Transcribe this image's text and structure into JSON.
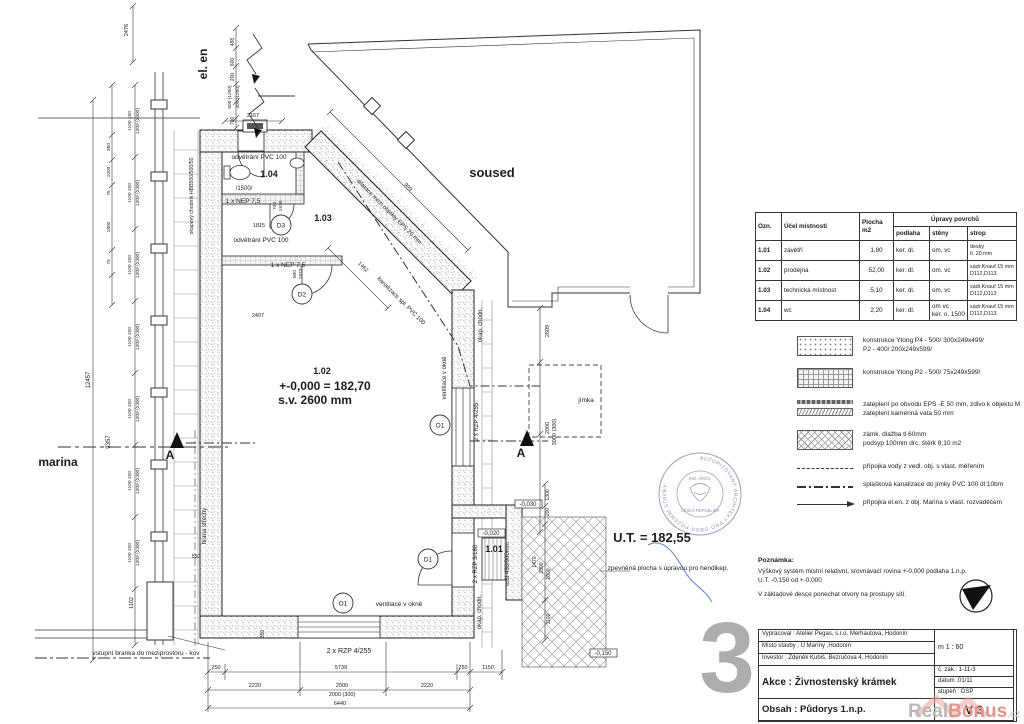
{
  "colors": {
    "ink": "#1c1c1c",
    "stamp_blue": "#8a90b2",
    "signature_blue": "#6e86c8",
    "watermark_grey": "#b8b8b8",
    "watermark_red": "#e2938b",
    "sheet_grey": "#999999"
  },
  "room_table": {
    "headers": [
      "Ozn.",
      "Účel místnosti",
      "Plocha\nm2",
      "Úpravy povrchů",
      "podlaha",
      "stěny",
      "strop"
    ],
    "rows": [
      [
        "1.01",
        "závětří",
        "1,80",
        "ker. dl.",
        "om. vc",
        "desky\ntl. 20 mm"
      ],
      [
        "1.02",
        "prodejna",
        "52,00",
        "ker. dl.",
        "om. vc",
        "sádr.Knauf 15 mm\nD112,D113"
      ],
      [
        "1.03",
        "technická místnost",
        "5,10",
        "ker. dl.",
        "om. vc",
        "sádr.Knauf 15 mm\nD112,D113"
      ],
      [
        "1.04",
        "wc",
        "2,20",
        "ker. dl.",
        "om vc\nker. o. 1500",
        "sádr.Knauf 15 mm\nD112,D113"
      ]
    ]
  },
  "legend": {
    "items": [
      {
        "swatch": "stipple",
        "flat": false,
        "lines": [
          "konstrukce  Ytong  P4 - 500/ 300x249x499/",
          "P2 - 400/ 200x249x599/"
        ]
      },
      {
        "swatch": "grid",
        "flat": false,
        "lines": [
          "konstrukce  Ytong  P2 - 500/ 75x249x599/"
        ]
      },
      {
        "swatch": "strips",
        "flat": false,
        "lines": [
          "zateplení po obvodu EPS -E  50 mm, zdivo k objektu M",
          "zateplení kamenná vata 50 mm"
        ]
      },
      {
        "swatch": "diamond",
        "flat": false,
        "lines": [
          "zámk. dlažba tl 60mm",
          "podsyp 100mm drc. štěrk  8,10 m2"
        ]
      },
      {
        "swatch": "dash",
        "flat": true,
        "lines": [
          "přípojka vody z vedl. obj. s vlast. měřením"
        ]
      },
      {
        "swatch": "dashdot",
        "flat": true,
        "lines": [
          "splašková kanalizace do jímky PVC 100 dl:10bm"
        ]
      },
      {
        "swatch": "arrow",
        "flat": true,
        "lines": [
          "přípojka el.en. z obj. Marina s vlast. rozvaděčem"
        ]
      }
    ]
  },
  "notes": {
    "title": "Poznámka:",
    "lines": [
      "Výškový systém místní relativní, srovnávací rovina +-0,000 podlaha 1.n.p.",
      "U.T. -0,150 od +-0,000",
      "V základové desce ponechat otvory na prostupy sítí."
    ]
  },
  "title_block": {
    "vypracoval": "Vypracoval : Atelier Pegas, s.r.o. Merhautova, Hodonín",
    "misto": "Místo stavby :  U Maríny ,Hodonín",
    "investor": "Investor : Zdeněk Kubiš, Bezručova 4, Hodonín",
    "akce": "Akce : Živnostenský krámek",
    "obsah": "Obsah : Půdorys 1.n.p.",
    "scale": "m  1 : 60",
    "zakazka": "č. zak.:  1-11-3",
    "datum": "datum :01/11",
    "stupen": "stupeň : DSP",
    "version": "V 3"
  },
  "sheet_number": "3",
  "stamp": {
    "ring": "AUTORIZOVANÝ ARCHITEKT PRO OBOR POZEMNÍ STAVBY",
    "inner1": "ING. ARCH.",
    "inner2": "ČESKÁ REPUBLIKA"
  },
  "watermark": {
    "real": "Real",
    "bonus": "Bonus",
    "cz": ".cz"
  },
  "plan": {
    "marks": [
      {
        "t": "D3",
        "x": 281,
        "y": 225
      },
      {
        "t": "D2",
        "x": 302,
        "y": 294
      },
      {
        "t": "D1",
        "x": 428,
        "y": 559
      },
      {
        "t": "O1",
        "x": 440,
        "y": 425
      },
      {
        "t": "O1",
        "x": 343,
        "y": 603
      }
    ],
    "labels": [
      {
        "n": "el-en-label",
        "t": "el. en",
        "x": 207,
        "y": 64,
        "r": -90,
        "s": 12,
        "b": 1
      },
      {
        "n": "soused-label",
        "t": "soused",
        "x": 492,
        "y": 177,
        "s": 13,
        "b": 1
      },
      {
        "n": "marina-label",
        "t": "marina",
        "x": 58,
        "y": 466,
        "s": 12,
        "b": 1
      },
      {
        "n": "vent-104",
        "t": "odvětrání PVC 100",
        "x": 259,
        "y": 159,
        "s": 6.5
      },
      {
        "n": "room-104-number",
        "t": "1.04",
        "x": 269,
        "y": 177,
        "s": 9,
        "b": 1
      },
      {
        "n": "flow-1500",
        "t": "/1500/",
        "x": 244,
        "y": 190,
        "s": 6
      },
      {
        "n": "nep-top",
        "t": "1 x NEP 7,5",
        "x": 243,
        "y": 203,
        "s": 6.5
      },
      {
        "n": "vent-103",
        "t": "odvětrání PVC 100",
        "x": 261,
        "y": 242,
        "s": 6.5
      },
      {
        "n": "nep-bottom",
        "t": "1 x NEP 7,5",
        "x": 288,
        "y": 267,
        "s": 6.5
      },
      {
        "n": "room-103-number",
        "t": "1.03",
        "x": 323,
        "y": 221,
        "s": 9,
        "b": 1
      },
      {
        "n": "dim-1815",
        "t": "1815",
        "x": 259,
        "y": 227,
        "s": 5.5
      },
      {
        "n": "dim-2407",
        "t": "2407",
        "x": 258,
        "y": 317,
        "s": 5.5
      },
      {
        "n": "dim-d3-700",
        "t": "700",
        "x": 276,
        "y": 206,
        "r": -90,
        "s": 4.8
      },
      {
        "n": "dim-d3-1970",
        "t": "1970",
        "x": 282,
        "y": 206,
        "r": -90,
        "s": 4.8
      },
      {
        "n": "dim-d2-800",
        "t": "800",
        "x": 296,
        "y": 274,
        "r": -90,
        "s": 4.8
      },
      {
        "n": "dim-d2-1970",
        "t": "1970",
        "x": 302,
        "y": 274,
        "r": -90,
        "s": 4.8
      },
      {
        "n": "room-102-number",
        "t": "1.02",
        "x": 322,
        "y": 374,
        "s": 9,
        "b": 1
      },
      {
        "n": "room-102-level",
        "t": "+-0,000 = 182,70",
        "x": 325,
        "y": 390,
        "s": 12,
        "b": 1
      },
      {
        "n": "room-102-height",
        "t": "s.v. 2600 mm",
        "x": 315,
        "y": 404,
        "s": 12,
        "b": 1
      },
      {
        "n": "vent-right",
        "t": "ventilace v okně",
        "x": 446,
        "y": 378,
        "r": -90,
        "s": 6
      },
      {
        "n": "rzp-right",
        "t": "2 x RZP 4/255",
        "x": 478,
        "y": 422,
        "r": -90,
        "s": 6
      },
      {
        "n": "okap-right",
        "t": "okap. chodn.",
        "x": 482,
        "y": 325,
        "r": -90,
        "s": 6
      },
      {
        "n": "okap-bottom-right",
        "t": "okap. chodn.",
        "x": 481,
        "y": 612,
        "r": -90,
        "s": 6
      },
      {
        "n": "okap-left",
        "t": "okapový chodník HBB500/500/50",
        "x": 193,
        "y": 196,
        "r": -90,
        "s": 5.2
      },
      {
        "n": "dim-2609",
        "t": "2609",
        "x": 549,
        "y": 331,
        "r": -90,
        "s": 5.5
      },
      {
        "n": "jimka-label",
        "t": "jímka",
        "x": 586,
        "y": 402,
        "s": 6.5
      },
      {
        "n": "dim-2000-jimka",
        "t": "2000",
        "x": 549,
        "y": 428,
        "r": -90,
        "s": 5.5
      },
      {
        "n": "dim-3000-300",
        "t": "3000 (300)",
        "x": 556,
        "y": 432,
        "r": -90,
        "s": 5.5
      },
      {
        "n": "section-a-left",
        "t": "A",
        "x": 170,
        "y": 459,
        "s": 12,
        "b": 1
      },
      {
        "n": "section-a-right",
        "t": "A",
        "x": 521,
        "y": 457,
        "s": 12,
        "b": 1
      },
      {
        "n": "room-101-number",
        "t": "1.01",
        "x": 494,
        "y": 552,
        "s": 9,
        "b": 1
      },
      {
        "n": "level-0020",
        "t": "-0,020",
        "x": 491,
        "y": 535,
        "s": 6
      },
      {
        "n": "level-0030",
        "t": "-0,030",
        "x": 528,
        "y": 506,
        "s": 6
      },
      {
        "n": "level-0150",
        "t": "-0,150",
        "x": 603,
        "y": 655,
        "s": 6
      },
      {
        "n": "rzp-porch",
        "t": "2 x RZP 3/180",
        "x": 477,
        "y": 564,
        "r": -90,
        "s": 6
      },
      {
        "n": "rost-label",
        "t": "rošt 450/900mm",
        "x": 509,
        "y": 564,
        "r": -90,
        "s": 6
      },
      {
        "n": "ut-level",
        "t": "U.T. = 182,55",
        "x": 652,
        "y": 542,
        "s": 13,
        "b": 1
      },
      {
        "n": "zpevnena-label",
        "t": "zpevněná plocha s úpravou pro hendikep.",
        "x": 668,
        "y": 570,
        "s": 6.5
      },
      {
        "n": "vent-bottom",
        "t": "ventilace v okně",
        "x": 399,
        "y": 606,
        "s": 6.5
      },
      {
        "n": "rzp-bottom",
        "t": "2 x RZP 4/255",
        "x": 349,
        "y": 653,
        "s": 7
      },
      {
        "n": "branka-label",
        "t": "vstupní branka do meziprostoru - kov",
        "x": 146,
        "y": 655,
        "s": 6.5
      },
      {
        "n": "hrana-strechy",
        "t": "hrana střechy",
        "x": 206,
        "y": 526,
        "r": -90,
        "s": 6
      },
      {
        "n": "dim-550",
        "t": "550",
        "x": 196,
        "y": 558,
        "s": 5
      },
      {
        "n": "dim-1102",
        "t": "1102",
        "x": 133,
        "y": 603,
        "r": -90,
        "s": 5.5
      },
      {
        "n": "dilatace-label",
        "t": "dilatace mezi objekty EPS 20 mm",
        "x": 388,
        "y": 213,
        "r": 45,
        "s": 6
      },
      {
        "n": "dim-999",
        "t": "999",
        "x": 407,
        "y": 188,
        "r": 45,
        "s": 5.5
      },
      {
        "n": "kanalizace-label",
        "t": "kanalizace spl. PVC 100",
        "x": 400,
        "y": 302,
        "r": 45,
        "s": 6
      },
      {
        "n": "dim-1462",
        "t": "1462",
        "x": 362,
        "y": 268,
        "r": 45,
        "s": 5.5
      },
      {
        "n": "dim-250a",
        "t": "250",
        "x": 216,
        "y": 669,
        "s": 5.5
      },
      {
        "n": "dim-5739",
        "t": "5739",
        "x": 341,
        "y": 669,
        "s": 5.5
      },
      {
        "n": "dim-250b",
        "t": "250",
        "x": 463,
        "y": 669,
        "s": 5.5
      },
      {
        "n": "dim-1150",
        "t": "1150",
        "x": 488,
        "y": 669,
        "s": 5.5
      },
      {
        "n": "dim-2220a",
        "t": "2220",
        "x": 255,
        "y": 687,
        "s": 5.5
      },
      {
        "n": "dim-2000b",
        "t": "2000",
        "x": 342,
        "y": 687,
        "s": 5.5
      },
      {
        "n": "dim-2220b",
        "t": "2220",
        "x": 427,
        "y": 687,
        "s": 5.5
      },
      {
        "n": "dim-2000-300",
        "t": "2000  (300)",
        "x": 342,
        "y": 696,
        "s": 5.5
      },
      {
        "n": "dim-6440",
        "t": "6440",
        "x": 340,
        "y": 705,
        "s": 5.5
      },
      {
        "n": "dim-350b",
        "t": "350",
        "x": 264,
        "y": 634,
        "r": -90,
        "s": 5
      },
      {
        "n": "dim-2167",
        "t": "2167",
        "x": 253,
        "y": 117,
        "s": 5.5
      },
      {
        "n": "dim-2476",
        "t": "2476",
        "x": 128,
        "y": 30,
        "r": -90,
        "s": 5.5
      },
      {
        "n": "dim-488",
        "t": "488",
        "x": 234,
        "y": 42,
        "r": -90,
        "s": 5
      },
      {
        "n": "dim-600a",
        "t": "600",
        "x": 234,
        "y": 62,
        "r": -90,
        "s": 5
      },
      {
        "n": "dim-200",
        "t": "200",
        "x": 234,
        "y": 77,
        "r": -90,
        "s": 5
      },
      {
        "n": "dim-600-1250",
        "t": "600 (1250)",
        "x": 231,
        "y": 97,
        "r": -90,
        "s": 4.8
      },
      {
        "n": "dim-400-1250",
        "t": "400 (1250)",
        "x": 239,
        "y": 97,
        "r": -90,
        "s": 4.8
      },
      {
        "n": "dim-700t",
        "t": "700",
        "x": 234,
        "y": 121,
        "r": -90,
        "s": 5
      },
      {
        "n": "dim-12457",
        "t": "12457",
        "x": 90,
        "y": 380,
        "r": -90,
        "s": 6
      },
      {
        "n": "dim-9357",
        "t": "9357",
        "x": 110,
        "y": 442,
        "r": -90,
        "s": 6
      },
      {
        "n": "dim-350L",
        "t": "350",
        "x": 110,
        "y": 147,
        "r": -90,
        "s": 4.8
      },
      {
        "n": "dim-1000L",
        "t": "1000",
        "x": 110,
        "y": 172,
        "r": -90,
        "s": 4.8
      },
      {
        "n": "dim-75a",
        "t": "75",
        "x": 110,
        "y": 193,
        "r": -90,
        "s": 4.8
      },
      {
        "n": "dim-1800L",
        "t": "1800",
        "x": 110,
        "y": 227,
        "r": -90,
        "s": 4.8
      },
      {
        "n": "dim-75b",
        "t": "75",
        "x": 110,
        "y": 262,
        "r": -90,
        "s": 4.8
      },
      {
        "n": "dim-w1a",
        "t": "1100 150",
        "x": 131,
        "y": 121,
        "r": -90,
        "s": 4.8
      },
      {
        "n": "dim-w1b",
        "t": "1200 (2400)",
        "x": 139,
        "y": 121,
        "r": -90,
        "s": 4.8
      },
      {
        "n": "dim-w2a",
        "t": "1100 150",
        "x": 131,
        "y": 193,
        "r": -90,
        "s": 4.8
      },
      {
        "n": "dim-w2b",
        "t": "1200 (2400)",
        "x": 139,
        "y": 193,
        "r": -90,
        "s": 4.8
      },
      {
        "n": "dim-w3a",
        "t": "1100 150",
        "x": 131,
        "y": 265,
        "r": -90,
        "s": 4.8
      },
      {
        "n": "dim-w3b",
        "t": "1200 (2400)",
        "x": 139,
        "y": 265,
        "r": -90,
        "s": 4.8
      },
      {
        "n": "dim-w4a",
        "t": "1100 150",
        "x": 131,
        "y": 337,
        "r": -90,
        "s": 4.8
      },
      {
        "n": "dim-w4b",
        "t": "1200 (2400)",
        "x": 139,
        "y": 337,
        "r": -90,
        "s": 4.8
      },
      {
        "n": "dim-w5a",
        "t": "1100 150",
        "x": 131,
        "y": 409,
        "r": -90,
        "s": 4.8
      },
      {
        "n": "dim-w5b",
        "t": "1200 (2400)",
        "x": 139,
        "y": 409,
        "r": -90,
        "s": 4.8
      },
      {
        "n": "dim-w6a",
        "t": "1100 150",
        "x": 131,
        "y": 481,
        "r": -90,
        "s": 4.8
      },
      {
        "n": "dim-w6b",
        "t": "1200 (2400)",
        "x": 139,
        "y": 481,
        "r": -90,
        "s": 4.8
      },
      {
        "n": "dim-w7a",
        "t": "1100 150",
        "x": 131,
        "y": 553,
        "r": -90,
        "s": 4.8
      },
      {
        "n": "dim-w7b",
        "t": "1200 (2400)",
        "x": 139,
        "y": 553,
        "r": -90,
        "s": 4.8
      },
      {
        "n": "dim-1300",
        "t": "1300",
        "x": 549,
        "y": 495,
        "r": -90,
        "s": 5
      },
      {
        "n": "dim-200p",
        "t": "200",
        "x": 549,
        "y": 512,
        "r": -90,
        "s": 5
      },
      {
        "n": "dim-1470",
        "t": "1470",
        "x": 536,
        "y": 562,
        "r": -90,
        "s": 5
      },
      {
        "n": "dim-2390",
        "t": "2390",
        "x": 543,
        "y": 568,
        "r": -90,
        "s": 5
      },
      {
        "n": "dim-1600",
        "t": "1600",
        "x": 550,
        "y": 574,
        "r": -90,
        "s": 5
      },
      {
        "n": "dim-1100p",
        "t": "1100",
        "x": 550,
        "y": 619,
        "r": -90,
        "s": 5
      }
    ]
  }
}
